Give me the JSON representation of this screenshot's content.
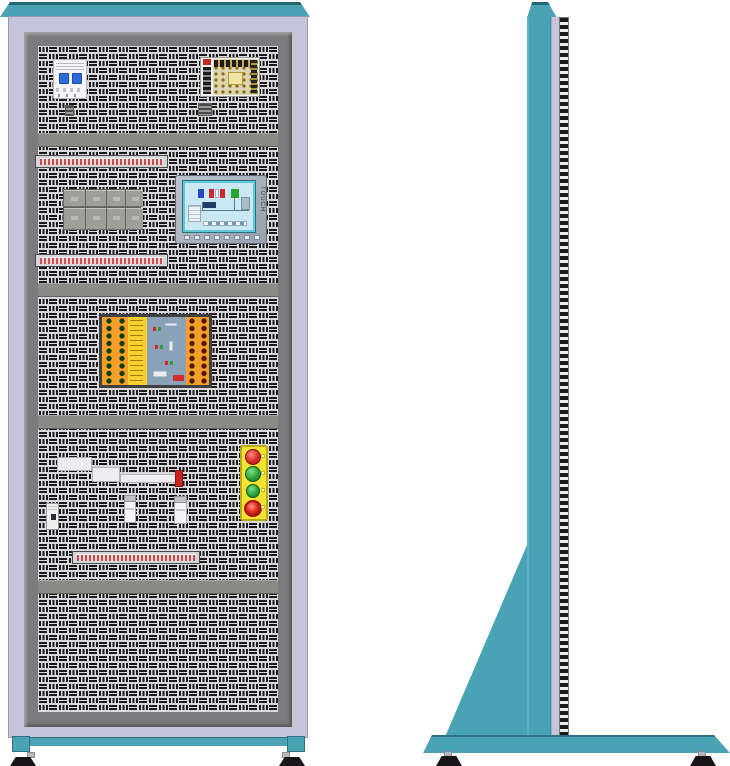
{
  "hmi": {
    "side_label": "TOUCH"
  },
  "colors": {
    "cabinet_teal": "#4AA3B5",
    "cabinet_teal_dark": "#236776",
    "cabinet_lavender": "#C6C4D9",
    "frame_gray": "#7B7B7D",
    "perforated_panel": "#D9D9DD",
    "perforation_slot": "#1A1A1C",
    "mounting_rail": "#8A8A86",
    "terminal_red": "#C75050",
    "button_plate_yellow": "#F2E332",
    "button_red": "#D42A28",
    "button_green": "#2AA23A",
    "estop_red": "#E03020",
    "plc_orange": "#F0A028",
    "plc_label_yellow": "#F7CF2E",
    "plc_pcb_blue": "#8AA2B8",
    "hmi_screen_blue": "#C9E8F3",
    "actuator_tip_red": "#CC2222",
    "breaker_handle_blue": "#2C6CD8"
  },
  "front_view": {
    "components": [
      {
        "name": "circuit-breaker"
      },
      {
        "name": "power-supply"
      },
      {
        "name": "terminal-strip",
        "count": 3
      },
      {
        "name": "relay-block-group"
      },
      {
        "name": "hmi-touch-panel"
      },
      {
        "name": "plc-trainer-board"
      },
      {
        "name": "pneumatic-actuator"
      },
      {
        "name": "proximity-sensor",
        "count": 2
      },
      {
        "name": "mini-relay"
      },
      {
        "name": "push-button-station",
        "buttons": [
          "red",
          "green",
          "green",
          "emergency-stop"
        ]
      },
      {
        "name": "mounting-rail",
        "count": 4
      },
      {
        "name": "leveling-foot",
        "count": 2
      }
    ]
  },
  "side_view": {
    "components": [
      {
        "name": "cabinet-column"
      },
      {
        "name": "perforated-panel-edge"
      },
      {
        "name": "support-gusset"
      },
      {
        "name": "floor-base"
      },
      {
        "name": "leveling-foot",
        "count": 2
      }
    ]
  }
}
